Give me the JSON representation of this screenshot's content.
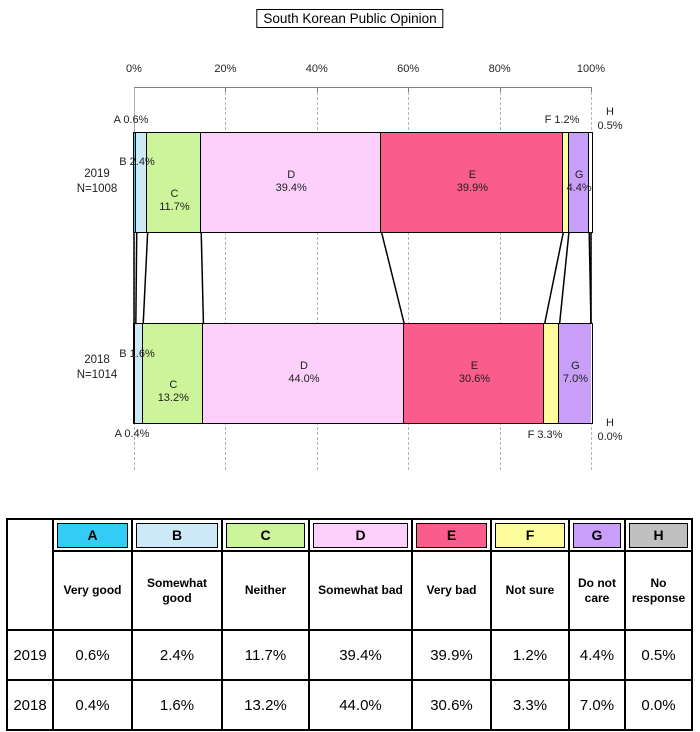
{
  "chart_data": {
    "type": "bar",
    "orientation": "horizontal",
    "stacking": "percent",
    "title": "South Korean Public Opinion",
    "x_axis": {
      "tick_labels": [
        "0%",
        "20%",
        "40%",
        "60%",
        "80%",
        "100%"
      ],
      "tick_values": [
        0,
        20,
        40,
        60,
        80,
        100
      ],
      "range": [
        0,
        100
      ],
      "gridlines": "dashed"
    },
    "categories": [
      {
        "key": "A",
        "label": "Very good",
        "color": "#33CCF5",
        "bar_color": "#33CCF5"
      },
      {
        "key": "B",
        "label": "Somewhat good",
        "color": "#CDE9F8",
        "bar_color": "#CDE9F8"
      },
      {
        "key": "C",
        "label": "Neither",
        "color": "#CCF49B",
        "bar_color": "#CCF49B"
      },
      {
        "key": "D",
        "label": "Somewhat bad",
        "color": "#FDD0FB",
        "bar_color": "#FDD0FB"
      },
      {
        "key": "E",
        "label": "Very bad",
        "color": "#FA5C8C",
        "bar_color": "#FA5C8C"
      },
      {
        "key": "F",
        "label": "Not sure",
        "color": "#FDFD9C",
        "bar_color": "#FDFD9C"
      },
      {
        "key": "G",
        "label": "Do not care",
        "color": "#C99EF9",
        "bar_color": "#C99EF9"
      },
      {
        "key": "H",
        "label": "No response",
        "color": "#C0C0C0",
        "bar_color": "#FFFFFF"
      }
    ],
    "series": [
      {
        "name": "2019",
        "n_label": "N=1008",
        "values": [
          0.6,
          2.4,
          11.7,
          39.4,
          39.9,
          1.2,
          4.4,
          0.5
        ]
      },
      {
        "name": "2018",
        "n_label": "N=1014",
        "values": [
          0.4,
          1.6,
          13.2,
          44.0,
          30.6,
          3.3,
          7.0,
          0.0
        ]
      }
    ],
    "inside_labeled_categories": [
      "C",
      "D",
      "E",
      "G"
    ],
    "outside_labeled_categories": [
      "A",
      "B",
      "F",
      "H"
    ]
  },
  "table": {
    "corner_label": "",
    "header_letters": [
      "A",
      "B",
      "C",
      "D",
      "E",
      "F",
      "G",
      "H"
    ],
    "header_labels": [
      "Very good",
      "Somewhat good",
      "Neither",
      "Somewhat bad",
      "Very bad",
      "Not sure",
      "Do not care",
      "No response"
    ],
    "rows": [
      {
        "year": "2019",
        "values": [
          "0.6%",
          "2.4%",
          "11.7%",
          "39.4%",
          "39.9%",
          "1.2%",
          "4.4%",
          "0.5%"
        ]
      },
      {
        "year": "2018",
        "values": [
          "0.4%",
          "1.6%",
          "13.2%",
          "44.0%",
          "30.6%",
          "3.3%",
          "7.0%",
          "0.0%"
        ]
      }
    ]
  },
  "colors": {
    "axis": "#808080",
    "gridline": "#b3b3b3",
    "border": "#000000",
    "background": "#ffffff"
  }
}
